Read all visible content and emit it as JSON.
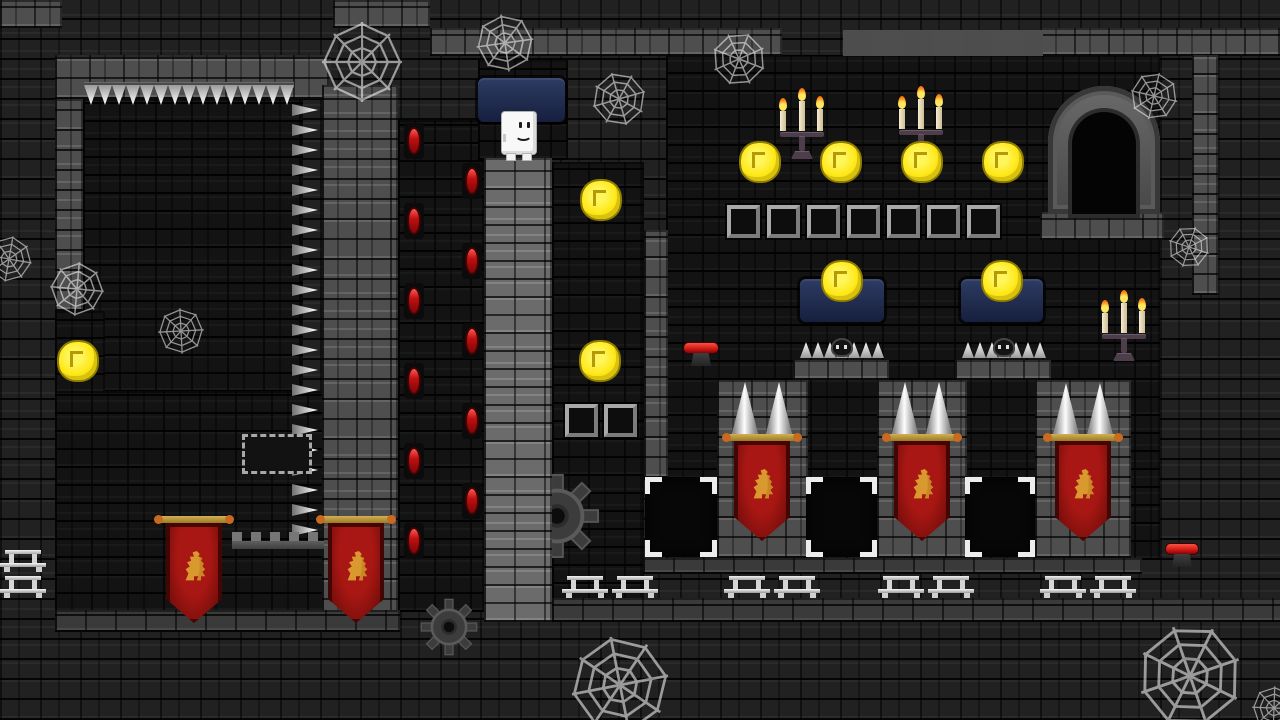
{
  "scene": {
    "type": "platformer-level",
    "theme": "castle-dungeon-night"
  },
  "palette": {
    "background_brick": "#212121",
    "interior_brick": "#131313",
    "wall_grey": "#4e4e4e",
    "wall_light": "#6b6b6b",
    "coin_yellow": "#ffe818",
    "banner_red": "#a81713",
    "lion_gold": "#d9992e",
    "window_blue": "#26345c",
    "flame_orange": "#ff9b1d",
    "spike_silver": "#e8e8e8",
    "gem_red": "#c01010",
    "lever_red": "#d41414"
  },
  "player": {
    "x": 502,
    "y": 112,
    "w": 34,
    "h": 48,
    "expression": "smile"
  },
  "layout": {
    "interiors": [
      {
        "name": "topleft-room",
        "x": 83,
        "y": 99,
        "w": 220,
        "h": 293
      },
      {
        "name": "left-shaft",
        "x": 55,
        "y": 311,
        "w": 50,
        "h": 82
      },
      {
        "name": "bottomleft-room",
        "x": 55,
        "y": 391,
        "w": 343,
        "h": 221
      },
      {
        "name": "torch-column",
        "x": 398,
        "y": 120,
        "w": 86,
        "h": 492
      },
      {
        "name": "window-shaft",
        "x": 478,
        "y": 60,
        "w": 90,
        "h": 100
      },
      {
        "name": "pillar-gap",
        "x": 552,
        "y": 162,
        "w": 92,
        "h": 458
      },
      {
        "name": "great-hall",
        "x": 666,
        "y": 55,
        "w": 494,
        "h": 505
      }
    ],
    "walls": [
      {
        "name": "cap-topleft",
        "tex": "grey",
        "x": 0,
        "y": 0,
        "w": 62,
        "h": 28
      },
      {
        "name": "cap-top-mid",
        "tex": "grey",
        "x": 333,
        "y": 0,
        "w": 97,
        "h": 28
      },
      {
        "name": "topleft-room-top-wall",
        "tex": "grey",
        "x": 55,
        "y": 55,
        "w": 276,
        "h": 44
      },
      {
        "name": "topleft-room-left-wall",
        "tex": "grey",
        "x": 55,
        "y": 99,
        "w": 28,
        "h": 212
      },
      {
        "name": "mid-wall-column",
        "tex": "grey",
        "x": 322,
        "y": 85,
        "w": 76,
        "h": 535
      },
      {
        "name": "player-pillar",
        "tex": "light",
        "x": 484,
        "y": 158,
        "w": 68,
        "h": 464
      },
      {
        "name": "divider-column",
        "tex": "grey",
        "x": 644,
        "y": 230,
        "w": 24,
        "h": 248
      },
      {
        "name": "top-ledge-left",
        "tex": "grey",
        "x": 430,
        "y": 28,
        "w": 352,
        "h": 28
      },
      {
        "name": "top-ledge-right",
        "tex": "grey",
        "x": 1040,
        "y": 28,
        "w": 242,
        "h": 28
      },
      {
        "name": "door-ledge",
        "tex": "grey",
        "x": 1040,
        "y": 212,
        "w": 124,
        "h": 28
      },
      {
        "name": "right-wall-column",
        "tex": "grey",
        "x": 1192,
        "y": 55,
        "w": 26,
        "h": 240
      },
      {
        "name": "window-ledge-1",
        "tex": "grey",
        "x": 793,
        "y": 360,
        "w": 96,
        "h": 20
      },
      {
        "name": "window-ledge-2",
        "tex": "grey",
        "x": 955,
        "y": 360,
        "w": 96,
        "h": 20
      },
      {
        "name": "pillar-1",
        "tex": "grey",
        "x": 717,
        "y": 380,
        "w": 91,
        "h": 178
      },
      {
        "name": "pillar-2",
        "tex": "grey",
        "x": 877,
        "y": 380,
        "w": 90,
        "h": 178
      },
      {
        "name": "pillar-3",
        "tex": "grey",
        "x": 1035,
        "y": 380,
        "w": 96,
        "h": 178
      },
      {
        "name": "right-floor",
        "tex": "greydark",
        "x": 643,
        "y": 558,
        "w": 499,
        "h": 16
      },
      {
        "name": "bottomleft-floor",
        "tex": "greydark",
        "x": 55,
        "y": 610,
        "w": 345,
        "h": 22
      },
      {
        "name": "bottom-band",
        "tex": "greydark",
        "x": 552,
        "y": 598,
        "w": 730,
        "h": 24
      }
    ]
  },
  "entities": {
    "coins": [
      {
        "x": 78,
        "y": 361
      },
      {
        "x": 601,
        "y": 200
      },
      {
        "x": 600,
        "y": 361
      },
      {
        "x": 760,
        "y": 162
      },
      {
        "x": 841,
        "y": 162
      },
      {
        "x": 922,
        "y": 162
      },
      {
        "x": 1003,
        "y": 162
      },
      {
        "x": 842,
        "y": 281
      },
      {
        "x": 1002,
        "y": 281
      }
    ],
    "windows": [
      {
        "x": 478,
        "y": 78,
        "w": 87,
        "h": 44
      },
      {
        "x": 800,
        "y": 279,
        "w": 84,
        "h": 43
      },
      {
        "x": 961,
        "y": 279,
        "w": 82,
        "h": 43
      }
    ],
    "candelabras": [
      {
        "x": 779,
        "y": 88
      },
      {
        "x": 898,
        "y": 86
      },
      {
        "x": 1101,
        "y": 290
      }
    ],
    "door": {
      "x": 1048,
      "y": 86,
      "w": 112,
      "h": 128
    },
    "torch_gems": [
      {
        "x": 404,
        "y": 123
      },
      {
        "x": 404,
        "y": 203
      },
      {
        "x": 404,
        "y": 283
      },
      {
        "x": 404,
        "y": 363
      },
      {
        "x": 404,
        "y": 443
      },
      {
        "x": 404,
        "y": 523
      },
      {
        "x": 462,
        "y": 163
      },
      {
        "x": 462,
        "y": 243
      },
      {
        "x": 462,
        "y": 323
      },
      {
        "x": 462,
        "y": 403
      },
      {
        "x": 462,
        "y": 483
      }
    ],
    "ceiling_spikes": {
      "x": 84,
      "y": 85,
      "count": 15,
      "pitch": 14
    },
    "wall_spikes": {
      "x": 292,
      "y": 104,
      "count": 22,
      "pitch": 20
    },
    "spike_strips": [
      {
        "x": 800,
        "y": 336,
        "w": 84
      },
      {
        "x": 962,
        "y": 336,
        "w": 84
      }
    ],
    "cone_spikes": [
      {
        "x": 730,
        "y": 382
      },
      {
        "x": 764,
        "y": 382
      },
      {
        "x": 890,
        "y": 382
      },
      {
        "x": 924,
        "y": 382
      },
      {
        "x": 1051,
        "y": 383
      },
      {
        "x": 1085,
        "y": 383
      }
    ],
    "banners": [
      {
        "x": 166,
        "y": 516
      },
      {
        "x": 328,
        "y": 516
      },
      {
        "x": 734,
        "y": 434
      },
      {
        "x": 894,
        "y": 434
      },
      {
        "x": 1055,
        "y": 434
      }
    ],
    "door_frames": [
      {
        "x": 645,
        "y": 477,
        "w": 72,
        "h": 80
      },
      {
        "x": 806,
        "y": 477,
        "w": 71,
        "h": 80
      },
      {
        "x": 965,
        "y": 477,
        "w": 70,
        "h": 80
      }
    ],
    "tile_row": {
      "x": 727,
      "y": 205,
      "count": 7,
      "pitch": 40,
      "size": 33
    },
    "tile_pair": [
      {
        "x": 565,
        "y": 404
      },
      {
        "x": 604,
        "y": 404
      }
    ],
    "sign": {
      "x": 242,
      "y": 434,
      "w": 70,
      "h": 40
    },
    "levers": [
      {
        "x": 684,
        "y": 343,
        "w": 34
      },
      {
        "x": 1166,
        "y": 544,
        "w": 32
      }
    ],
    "benches": [
      {
        "x": 0,
        "y": 550
      },
      {
        "x": 0,
        "y": 576
      },
      {
        "x": 562,
        "y": 576
      },
      {
        "x": 612,
        "y": 576
      },
      {
        "x": 724,
        "y": 576
      },
      {
        "x": 774,
        "y": 576
      },
      {
        "x": 878,
        "y": 576
      },
      {
        "x": 928,
        "y": 576
      },
      {
        "x": 1040,
        "y": 576
      },
      {
        "x": 1090,
        "y": 576
      }
    ],
    "gears": [
      {
        "x": 514,
        "y": 473,
        "s": 86
      },
      {
        "x": 420,
        "y": 598,
        "s": 58
      }
    ],
    "webs": [
      {
        "x": 322,
        "y": 22,
        "s": 80
      },
      {
        "x": 476,
        "y": 14,
        "s": 58
      },
      {
        "x": 592,
        "y": 72,
        "s": 54
      },
      {
        "x": 712,
        "y": 32,
        "s": 54
      },
      {
        "x": 1130,
        "y": 72,
        "s": 48
      },
      {
        "x": 50,
        "y": 262,
        "s": 54
      },
      {
        "x": 158,
        "y": 308,
        "s": 46
      },
      {
        "x": 571,
        "y": 636,
        "s": 98
      },
      {
        "x": 1138,
        "y": 624,
        "s": 104
      },
      {
        "x": 1168,
        "y": 226,
        "s": 42
      },
      {
        "x": -14,
        "y": 236,
        "s": 46
      },
      {
        "x": 1252,
        "y": 686,
        "s": 44
      }
    ],
    "crenellations": [
      {
        "x": 232,
        "y": 532,
        "w": 92,
        "h": 17,
        "style": "sm"
      },
      {
        "x": 843,
        "y": 30,
        "w": 200,
        "h": 26,
        "style": "bg2"
      }
    ]
  }
}
